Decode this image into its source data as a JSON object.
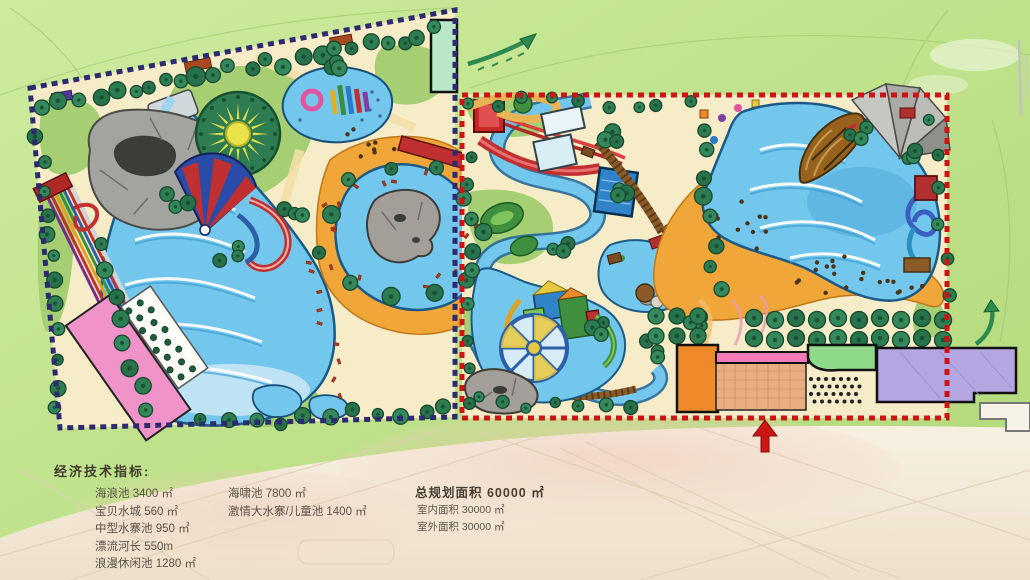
{
  "legend": {
    "title": "经济技术指标:",
    "items_left": [
      "海浪池 3400 ㎡",
      "宝贝水城 560 ㎡",
      "中型水寨池 950 ㎡",
      "漂流河长 550m",
      "浪漫休闲池 1280 ㎡"
    ],
    "items_middle": [
      "海啸池 7800 ㎡",
      "激情大水寨/儿童池 1400 ㎡"
    ],
    "summary_title": "总规划面积 60000 ㎡",
    "summary_items": [
      "室内面积 30000 ㎡",
      "室外面积 30000 ㎡"
    ]
  },
  "map": {
    "zones": [
      {
        "name": "west-parcel",
        "border_style": "dashed",
        "border_color": "#2e2a72"
      },
      {
        "name": "east-parcel",
        "border_style": "dashed",
        "border_color": "#cc1414"
      }
    ],
    "features": [
      "wave-pool",
      "racing-slides",
      "rock-cave",
      "sun-splash-feature",
      "funnel-cone-slide",
      "kids-pool",
      "lagoon-rock-island",
      "pink-service-building",
      "green-roof-building",
      "lazy-river",
      "mini-golf-greens",
      "red-slide-tower",
      "square-pools",
      "tsunami-pool",
      "pirate-ship",
      "grey-canopy-tent",
      "orange-beach",
      "kids-water-fort",
      "water-wheel",
      "orchard-trees",
      "entrance-plaza",
      "orange-building",
      "pink-walkway",
      "green-pavilion",
      "purple-building",
      "entrance-arrow-icon",
      "flow-arrow-icons"
    ]
  },
  "palette": {
    "grass": "#bfe08a",
    "paper": "#f3ead9",
    "parcel_sand": "#f7ecc8",
    "water": "#74c7ec",
    "water_deep": "#3f9ed0",
    "beach_orange": "#f0a638",
    "tree_green": "#2e7d52",
    "west_border": "#2e2a72",
    "east_border": "#cc1414",
    "accent_red": "#cc2222",
    "building_pink": "#ef93c8",
    "building_orange": "#ef8a2a",
    "building_green": "#8fd98a",
    "building_purple": "#b4a6e0",
    "arrow_green": "#2e8b4f"
  }
}
